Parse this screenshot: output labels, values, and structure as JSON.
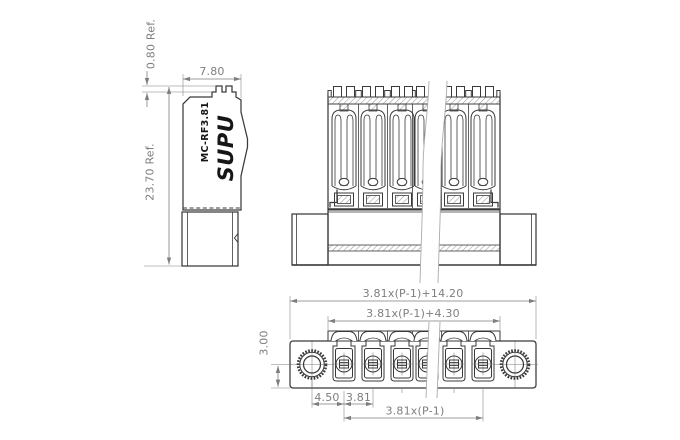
{
  "title": "SUPU MC-RF3.81 terminal block technical drawing",
  "colors": {
    "bg": "#ffffff",
    "line": "#3a3a3a",
    "dim": "#7e7e7e",
    "logo": "#161616",
    "break": "#ababab"
  },
  "side_view": {
    "logo": "SUPU",
    "model": "MC-RF3.81",
    "dim_tab_height": "0.80 Ref.",
    "dim_width": "7.80",
    "dim_height": "23.70 Ref."
  },
  "front_view": {
    "positions_visible": 6
  },
  "bottom_view": {
    "positions_visible": 6,
    "dim_overall_width": "3.81x(P-1)+14.20",
    "dim_header_width": "3.81x(P-1)+4.30",
    "dim_hole_offset": "3.00",
    "dim_end_to_first": "4.50",
    "dim_pitch": "3.81",
    "dim_span": "3.81x(P-1)"
  }
}
